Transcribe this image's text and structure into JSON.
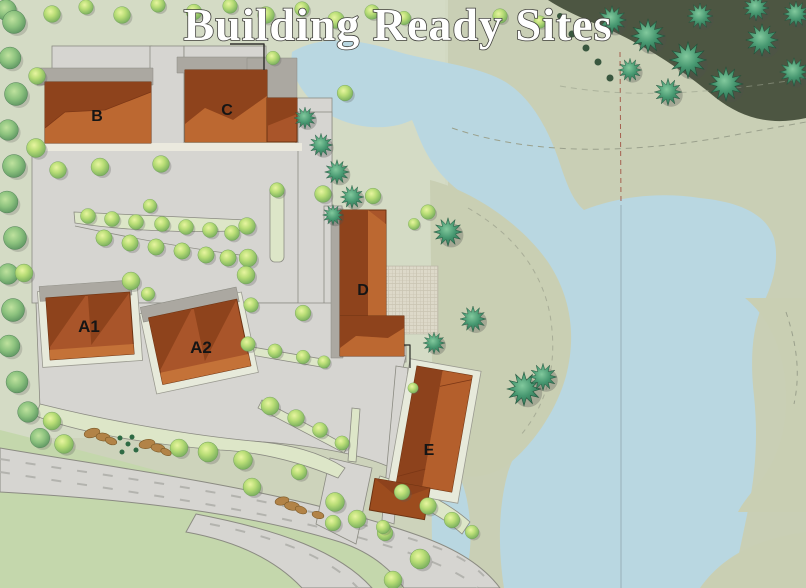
{
  "title": "Building Ready Sites",
  "map": {
    "type": "site-plan",
    "buildings": [
      {
        "id": "B",
        "label": "B"
      },
      {
        "id": "C",
        "label": "C"
      },
      {
        "id": "D",
        "label": "D"
      },
      {
        "id": "A1",
        "label": "A1"
      },
      {
        "id": "A2",
        "label": "A2"
      },
      {
        "id": "E",
        "label": "E"
      }
    ]
  },
  "colors": {
    "title_fill": "#ffffff",
    "title_outline": "#3f3f3b",
    "grass": "#cdd3bb",
    "grass_tan": "#c6ccb0",
    "lawn_light": "#dce3cf",
    "grass_bottom": "#c4d7ac",
    "water": "#b9d7e1",
    "forest": "#4d5642",
    "pavement": "#d6d5d1",
    "median": "#c4d7ac",
    "island": "#dde6c8",
    "pad": "#e7eadb",
    "curb": "#8b8b82",
    "building": "#a9552a",
    "building_dark": "#8e431c",
    "building_light": "#bf6c33",
    "roof_gray": "#aba8a1",
    "tree_light": "#b8dd76",
    "tree_medium": "#8cc27e",
    "tree_dark": "#469770",
    "shrub": "#b28347",
    "label_color": "#151515"
  }
}
